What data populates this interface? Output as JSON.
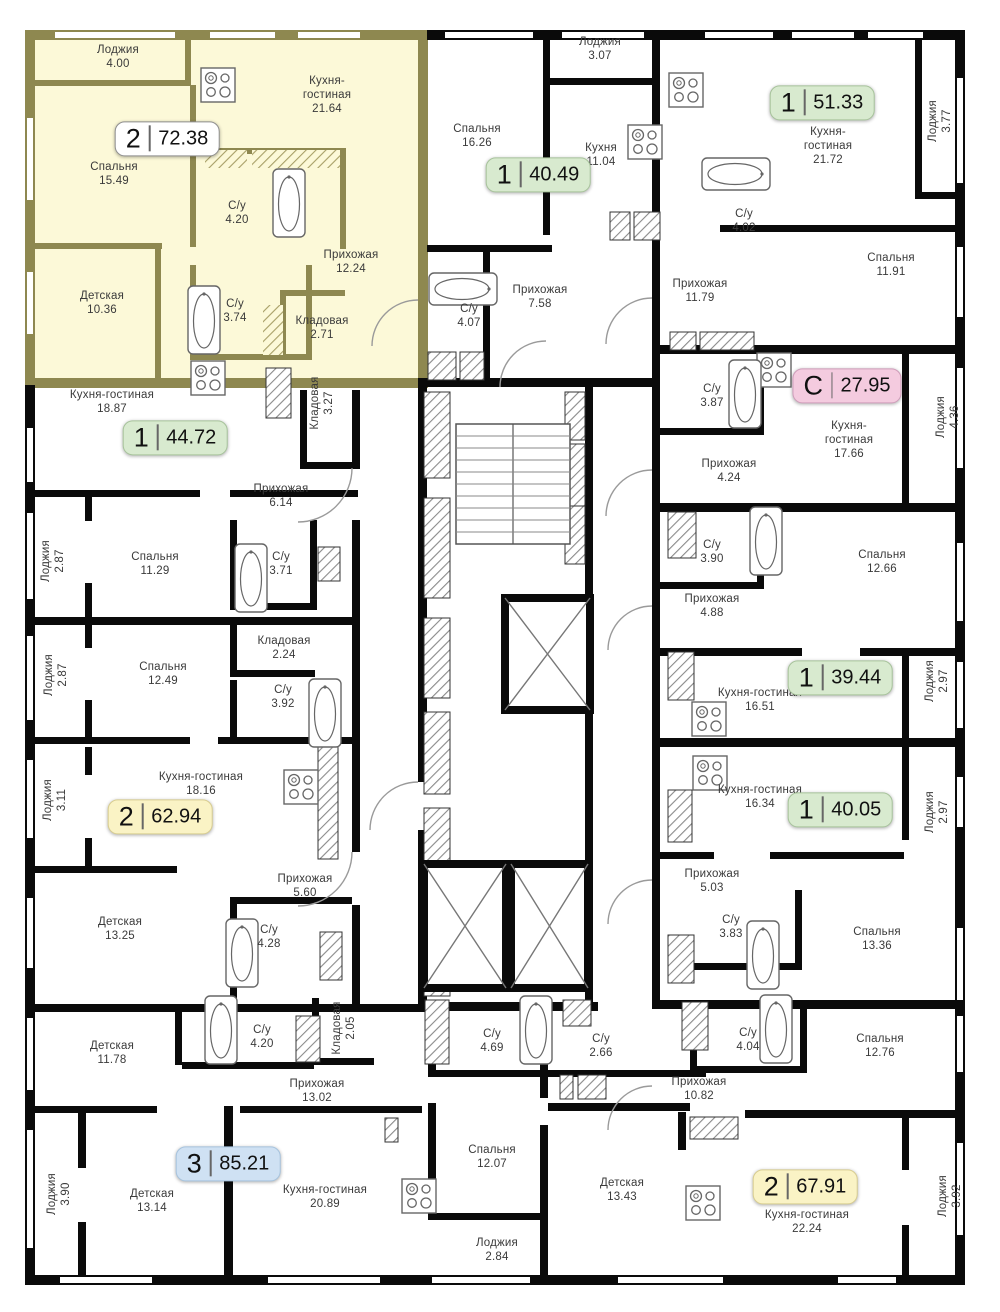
{
  "plan": {
    "title": "Residential floor plan",
    "colors": {
      "wall": "#0a0a0a",
      "highlight_wall": "#8e8850",
      "highlight_fill": "#fcf9d8",
      "background": "#ffffff",
      "label_text": "#3a3a3a"
    },
    "badge_palette": {
      "white": {
        "bg": "#ffffff",
        "border": "#8f8f8f"
      },
      "green": {
        "bg": "#d8eacf",
        "border": "#a7c39b"
      },
      "pink": {
        "bg": "#f4cbdf",
        "border": "#cf9dba"
      },
      "yellow": {
        "bg": "#faf3c5",
        "border": "#d8cd90"
      },
      "blue": {
        "bg": "#cfe1f3",
        "border": "#a6c3de"
      }
    },
    "apartments": [
      {
        "badge": {
          "label": "2",
          "area": "72.38",
          "color": "white"
        },
        "x": 167,
        "y": 139,
        "highlighted": true,
        "rooms": [
          {
            "name": "Лоджия",
            "area": "4.00",
            "x": 118,
            "y": 57
          },
          {
            "name": "Кухня-гостиная",
            "area": "21.64",
            "x": 327,
            "y": 95,
            "w": 70
          },
          {
            "name": "Спальня",
            "area": "15.49",
            "x": 114,
            "y": 174
          },
          {
            "name": "С/у",
            "area": "4.20",
            "x": 237,
            "y": 213
          },
          {
            "name": "Прихожая",
            "area": "12.24",
            "x": 351,
            "y": 262
          },
          {
            "name": "Детская",
            "area": "10.36",
            "x": 102,
            "y": 303
          },
          {
            "name": "С/у",
            "area": "3.74",
            "x": 235,
            "y": 311
          },
          {
            "name": "Кладовая",
            "area": "2.71",
            "x": 322,
            "y": 328
          }
        ]
      },
      {
        "badge": {
          "label": "1",
          "area": "40.49",
          "color": "green"
        },
        "x": 538,
        "y": 175,
        "highlighted": false,
        "rooms": [
          {
            "name": "Лоджия",
            "area": "3.07",
            "x": 600,
            "y": 49
          },
          {
            "name": "Спальня",
            "area": "16.26",
            "x": 477,
            "y": 136
          },
          {
            "name": "Кухня",
            "area": "11.04",
            "x": 601,
            "y": 155
          },
          {
            "name": "Прихожая",
            "area": "7.58",
            "x": 540,
            "y": 297
          },
          {
            "name": "С/у",
            "area": "4.07",
            "x": 469,
            "y": 316
          }
        ]
      },
      {
        "badge": {
          "label": "1",
          "area": "51.33",
          "color": "green"
        },
        "x": 822,
        "y": 103,
        "highlighted": false,
        "rooms": [
          {
            "name": "Кухня-гостиная",
            "area": "21.72",
            "x": 828,
            "y": 146,
            "w": 75
          },
          {
            "name": "Лоджия",
            "area": "3.77",
            "x": 940,
            "y": 121,
            "dir": "v"
          },
          {
            "name": "С/у",
            "area": "4.02",
            "x": 744,
            "y": 221
          },
          {
            "name": "Прихожая",
            "area": "11.79",
            "x": 700,
            "y": 291
          },
          {
            "name": "Спальня",
            "area": "11.91",
            "x": 891,
            "y": 265
          }
        ]
      },
      {
        "badge": {
          "label": "С",
          "area": "27.95",
          "color": "pink"
        },
        "x": 847,
        "y": 386,
        "highlighted": false,
        "rooms": [
          {
            "name": "С/у",
            "area": "3.87",
            "x": 712,
            "y": 396
          },
          {
            "name": "Кухня-гостиная",
            "area": "17.66",
            "x": 849,
            "y": 440,
            "w": 78
          },
          {
            "name": "Лоджия",
            "area": "4.36",
            "x": 948,
            "y": 417,
            "dir": "v"
          },
          {
            "name": "Прихожая",
            "area": "4.24",
            "x": 729,
            "y": 471
          }
        ]
      },
      {
        "badge": {
          "label": "1",
          "area": "44.72",
          "color": "green"
        },
        "x": 175,
        "y": 438,
        "highlighted": false,
        "rooms": [
          {
            "name": "Кухня-гостиная",
            "area": "18.87",
            "x": 112,
            "y": 402,
            "w": 150
          },
          {
            "name": "Кладовая",
            "area": "3.27",
            "x": 322,
            "y": 403,
            "dir": "v"
          },
          {
            "name": "Прихожая",
            "area": "6.14",
            "x": 281,
            "y": 496
          },
          {
            "name": "Лоджия",
            "area": "2.87",
            "x": 53,
            "y": 561,
            "dir": "v"
          },
          {
            "name": "Спальня",
            "area": "11.29",
            "x": 155,
            "y": 564
          },
          {
            "name": "С/у",
            "area": "3.71",
            "x": 281,
            "y": 564
          }
        ]
      },
      {
        "badge": {
          "label": "1",
          "area": "39.44",
          "color": "green"
        },
        "x": 840,
        "y": 678,
        "highlighted": false,
        "rooms": [
          {
            "name": "С/у",
            "area": "3.90",
            "x": 712,
            "y": 552
          },
          {
            "name": "Спальня",
            "area": "12.66",
            "x": 882,
            "y": 562
          },
          {
            "name": "Прихожая",
            "area": "4.88",
            "x": 712,
            "y": 606
          },
          {
            "name": "Кухня-гостиная",
            "area": "16.51",
            "x": 760,
            "y": 700,
            "w": 85
          },
          {
            "name": "Лоджия",
            "area": "2.97",
            "x": 937,
            "y": 681,
            "dir": "v"
          }
        ]
      },
      {
        "badge": {
          "label": "1",
          "area": "40.05",
          "color": "green"
        },
        "x": 840,
        "y": 810,
        "highlighted": false,
        "rooms": [
          {
            "name": "Кухня-гостиная",
            "area": "16.34",
            "x": 760,
            "y": 797,
            "w": 85
          },
          {
            "name": "Лоджия",
            "area": "2.97",
            "x": 937,
            "y": 812,
            "dir": "v"
          },
          {
            "name": "Прихожая",
            "area": "5.03",
            "x": 712,
            "y": 881
          },
          {
            "name": "С/у",
            "area": "3.83",
            "x": 731,
            "y": 927
          },
          {
            "name": "Спальня",
            "area": "13.36",
            "x": 877,
            "y": 939
          }
        ]
      },
      {
        "badge": {
          "label": "2",
          "area": "62.94",
          "color": "yellow"
        },
        "x": 160,
        "y": 817,
        "highlighted": false,
        "rooms": [
          {
            "name": "Кладовая",
            "area": "2.24",
            "x": 284,
            "y": 648
          },
          {
            "name": "Спальня",
            "area": "12.49",
            "x": 163,
            "y": 674
          },
          {
            "name": "Лоджия",
            "area": "2.87",
            "x": 56,
            "y": 675,
            "dir": "v"
          },
          {
            "name": "С/у",
            "area": "3.92",
            "x": 283,
            "y": 697
          },
          {
            "name": "Лоджия",
            "area": "3.11",
            "x": 55,
            "y": 800,
            "dir": "v"
          },
          {
            "name": "Кухня-гостиная",
            "area": "18.16",
            "x": 201,
            "y": 784,
            "w": 170
          },
          {
            "name": "Прихожая",
            "area": "5.60",
            "x": 305,
            "y": 886
          },
          {
            "name": "Детская",
            "area": "13.25",
            "x": 120,
            "y": 929
          },
          {
            "name": "С/у",
            "area": "4.28",
            "x": 269,
            "y": 937
          }
        ]
      },
      {
        "badge": {
          "label": "3",
          "area": "85.21",
          "color": "blue"
        },
        "x": 228,
        "y": 1164,
        "highlighted": false,
        "rooms": [
          {
            "name": "С/у",
            "area": "4.20",
            "x": 262,
            "y": 1037
          },
          {
            "name": "Детская",
            "area": "11.78",
            "x": 112,
            "y": 1053
          },
          {
            "name": "Кладовая",
            "area": "2.05",
            "x": 344,
            "y": 1028,
            "dir": "v"
          },
          {
            "name": "С/у",
            "area": "4.69",
            "x": 492,
            "y": 1041
          },
          {
            "name": "Прихожая",
            "area": "13.02",
            "x": 317,
            "y": 1091
          },
          {
            "name": "Спальня",
            "area": "12.07",
            "x": 492,
            "y": 1157
          },
          {
            "name": "Лоджия",
            "area": "3.90",
            "x": 59,
            "y": 1194,
            "dir": "v"
          },
          {
            "name": "Детская",
            "area": "13.14",
            "x": 152,
            "y": 1201
          },
          {
            "name": "Кухня-гостиная",
            "area": "20.89",
            "x": 325,
            "y": 1197,
            "w": 170
          },
          {
            "name": "Лоджия",
            "area": "2.84",
            "x": 497,
            "y": 1250
          }
        ]
      },
      {
        "badge": {
          "label": "2",
          "area": "67.91",
          "color": "yellow"
        },
        "x": 805,
        "y": 1187,
        "highlighted": false,
        "rooms": [
          {
            "name": "С/у",
            "area": "2.66",
            "x": 601,
            "y": 1046
          },
          {
            "name": "С/у",
            "area": "4.04",
            "x": 748,
            "y": 1040
          },
          {
            "name": "Спальня",
            "area": "12.76",
            "x": 880,
            "y": 1046
          },
          {
            "name": "Прихожая",
            "area": "10.82",
            "x": 699,
            "y": 1089
          },
          {
            "name": "Детская",
            "area": "13.43",
            "x": 622,
            "y": 1190
          },
          {
            "name": "Кухня-гостиная",
            "area": "22.24",
            "x": 807,
            "y": 1222,
            "w": 170
          },
          {
            "name": "Лоджия",
            "area": "3.92",
            "x": 950,
            "y": 1196,
            "dir": "v"
          }
        ]
      }
    ]
  }
}
